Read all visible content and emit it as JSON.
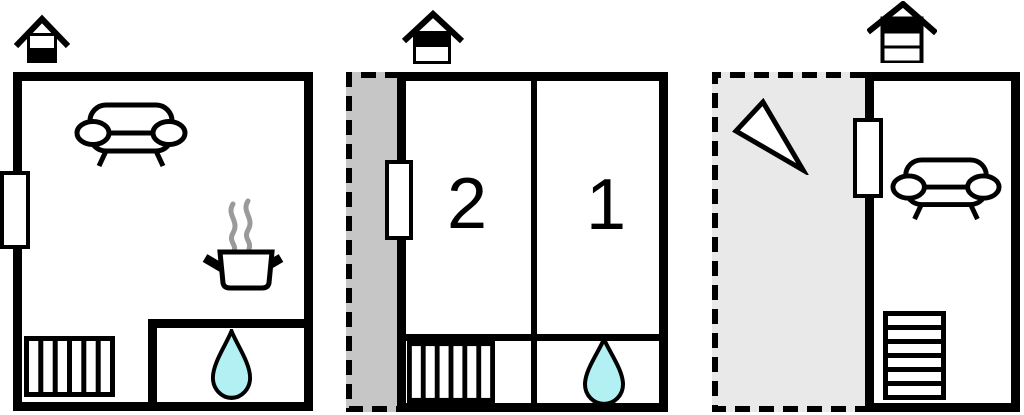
{
  "canvas": {
    "background": "#ffffff"
  },
  "colors": {
    "wall": "#000000",
    "terrace_mid_fill": "#c6c6c6",
    "terrace_right_fill": "#e9e9e9",
    "water_drop_fill": "#b2f0f4",
    "steam": "#9a9a9a",
    "furniture_fill": "#ffffff"
  },
  "panels": {
    "left": {
      "icons": [
        "chimney-icon",
        "window-icon",
        "sofa-icon",
        "cooking-pot-icon",
        "stairs-icon",
        "water-drop-icon"
      ]
    },
    "middle": {
      "rooms": [
        {
          "label": "2"
        },
        {
          "label": "1"
        }
      ],
      "icons": [
        "chimney-icon",
        "window-icon",
        "stairs-icon",
        "water-drop-icon",
        "terrace-dashed-area"
      ]
    },
    "right": {
      "icons": [
        "chimney-icon",
        "window-icon",
        "direction-triangle-icon",
        "sofa-icon",
        "stairs-icon",
        "terrace-dashed-area"
      ]
    }
  }
}
